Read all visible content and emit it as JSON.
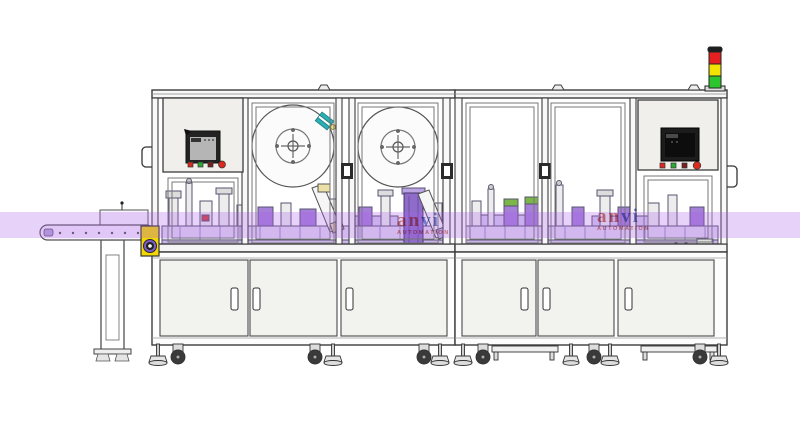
{
  "watermark": {
    "part1": "an",
    "part2": "vi",
    "subtitle": "AUTOMATION"
  },
  "colors": {
    "highlight_band": "#A85CE8",
    "machinery_purple": "#A57FD8",
    "machinery_purple_dark": "#8F6CC9",
    "tower_red": "#E62020",
    "tower_yellow": "#F2E300",
    "tower_green": "#2DC52D",
    "tower_cap": "#1E1E1E",
    "motor_yellow": "#F2D800",
    "button_red": "#D92A1E",
    "button_green": "#2FA832",
    "button_dark": "#7A1F1F",
    "teal_accent": "#2AAFB4",
    "panel_gray": "#F0EFEC",
    "outline": "#3C3C3C"
  },
  "signal_tower": {
    "lights": [
      "red",
      "yellow",
      "green"
    ]
  },
  "hmi_left": {
    "button_count": 4
  },
  "hmi_right": {
    "button_count": 4
  },
  "cabinet_doors": {
    "left": 3,
    "right": 3
  }
}
